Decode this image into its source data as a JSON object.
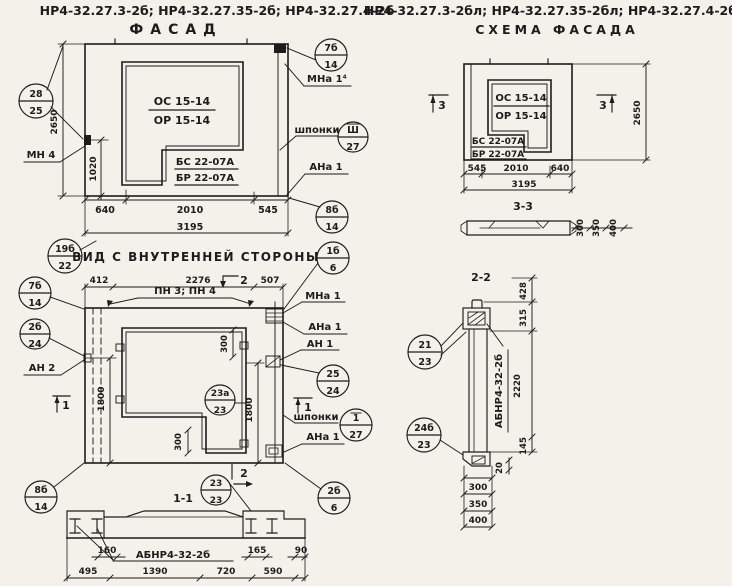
{
  "headers": {
    "left_models": "НР4-32.27.3-2б; НР4-32.27.35-2б; НР4-32.27.4-2б",
    "left_title": "ФАСАД",
    "right_models": "НР4-32.27.3-2бл; НР4-32.27.35-2бл; НР4-32.27.4-2бл",
    "right_title": "СХЕМА ФАСАДА"
  },
  "facade": {
    "marks": {
      "os": "ОС 15-14",
      "or": "ОР 15-14",
      "bs": "БС 22-07А",
      "br": "БР 22-07А"
    },
    "dims": {
      "h2650": "2650",
      "v1020": "1020",
      "w640": "640",
      "w2010": "2010",
      "w545": "545",
      "total": "3195"
    },
    "labels": {
      "mn4": "МН 4",
      "mna14": "МНа 1⁴",
      "shponki": "шпонки",
      "ana1": "АНа 1"
    },
    "callouts": {
      "c28": {
        "top": "28",
        "bottom": "25"
      },
      "c7b": {
        "top": "7б",
        "bottom": "14"
      },
      "csh": {
        "top": "Ш",
        "bottom": "27"
      },
      "c8b": {
        "top": "8б",
        "bottom": "14"
      }
    }
  },
  "inner": {
    "title": "ВИД С ВНУТРЕННЕЙ СТОРОНЫ",
    "dims": {
      "w412": "412",
      "w2276": "2276",
      "w507": "507",
      "h1800l": "1800",
      "h1800r": "1800",
      "d300t": "300",
      "d300b": "300"
    },
    "labels": {
      "pn": "ПН 3; ПН 4",
      "an2": "АН 2",
      "mna1": "МНа 1",
      "ana1_top": "АНа 1",
      "an1": "АН 1",
      "shponki": "шпонки",
      "ana1_bottom": "АНа 1"
    },
    "flags": {
      "one": "1",
      "two": "2"
    },
    "callouts": {
      "c19b": {
        "top": "19б",
        "bottom": "22"
      },
      "c7b": {
        "top": "7б",
        "bottom": "14"
      },
      "c2b24": {
        "top": "2б",
        "bottom": "24"
      },
      "c1b6": {
        "top": "1б",
        "bottom": "6"
      },
      "c25": {
        "top": "25",
        "bottom": "24"
      },
      "c127": {
        "top": "1",
        "bottom": "27"
      },
      "c23a": {
        "top": "23а",
        "bottom": "23"
      },
      "c2b6": {
        "top": "2б",
        "bottom": "6"
      },
      "c8b": {
        "top": "8б",
        "bottom": "14"
      },
      "c2323": {
        "top": "23",
        "bottom": "23"
      }
    }
  },
  "section11": {
    "title": "1-1",
    "label": "АБНР4-32-2б",
    "dims": {
      "d160": "160",
      "d165": "165",
      "d90": "90",
      "d495": "495",
      "d1390": "1390",
      "d720": "720",
      "d590": "590"
    }
  },
  "schema": {
    "marks": {
      "os": "ОС 15-14",
      "or": "ОР 15-14",
      "bs": "БС 22-07А",
      "br": "БР 22-07А"
    },
    "dims": {
      "w545": "545",
      "w2010": "2010",
      "w640": "640",
      "total": "3195",
      "h2650": "2650"
    },
    "flags": {
      "three": "3"
    }
  },
  "section33": {
    "title": "3-3",
    "dims": {
      "d300": "300",
      "d350": "350",
      "d400": "400"
    }
  },
  "section22": {
    "title": "2-2",
    "label": "АБНР4-32-2б",
    "dims": {
      "d428": "428",
      "d315": "315",
      "d2220": "2220",
      "d145": "145",
      "d20": "20",
      "d300": "300",
      "d350": "350",
      "d400": "400"
    },
    "callouts": {
      "c21": {
        "top": "21",
        "bottom": "23"
      },
      "c24b": {
        "top": "24б",
        "bottom": "23"
      }
    }
  }
}
